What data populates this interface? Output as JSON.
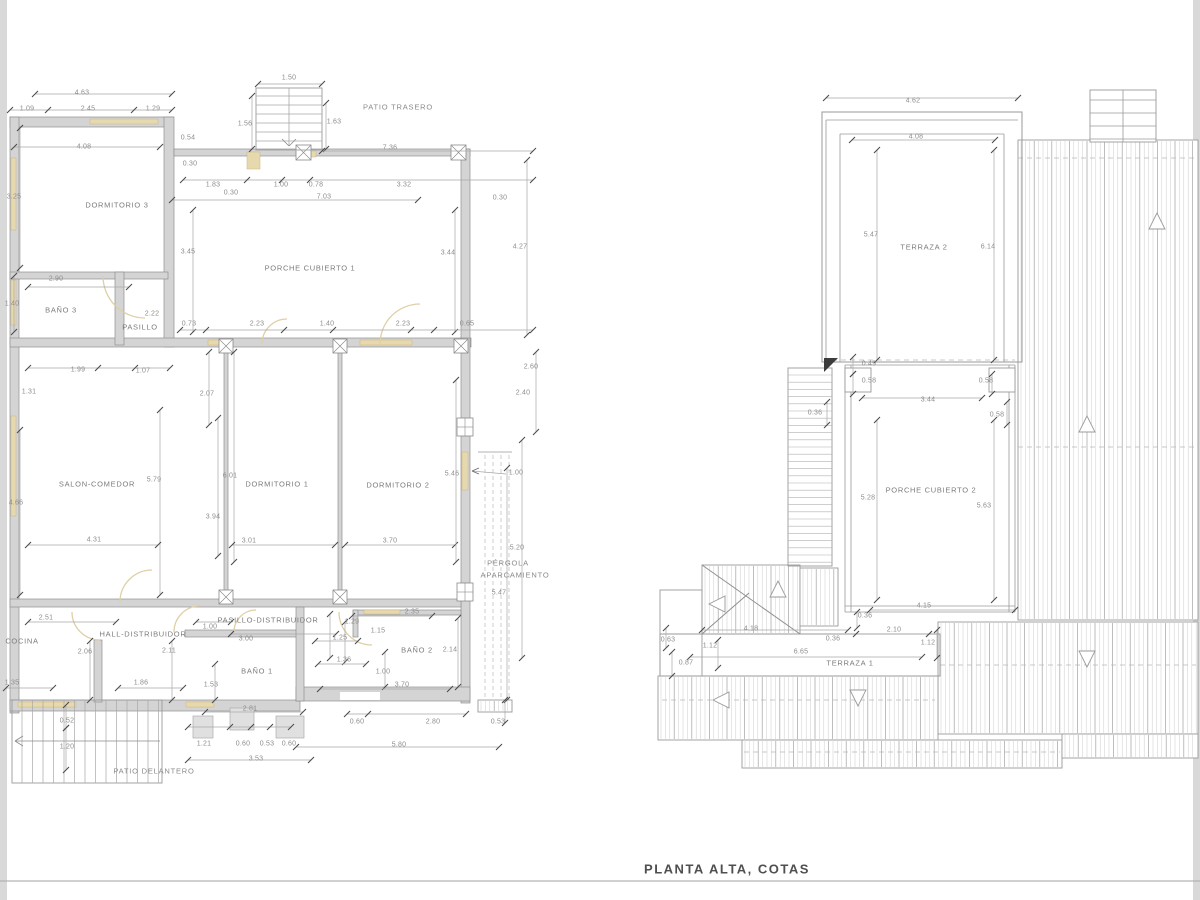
{
  "sheet_title": "PLANTA ALTA, COTAS",
  "colors": {
    "wall_fill": "#d4d4d4",
    "window_tan": "#e7d9ae",
    "door_arc": "#dfcfa5",
    "line_gray": "#9a9a9a",
    "text_gray": "#8a8a8a",
    "edge_strip": "#d9d9d9"
  },
  "left_plan": {
    "rooms_summary": [
      "DORMITORIO 3",
      "BAÑO 3",
      "PASILLO",
      "PORCHE CUBIERTO 1",
      "SALON-COMEDOR",
      "DORMITORIO 1",
      "DORMITORIO 2",
      "COCINA",
      "HALL-DISTRIBUIDOR",
      "PASILLO-DISTRIBUIDOR",
      "BAÑO 1",
      "BAÑO 2"
    ],
    "outdoor_areas": [
      "PATIO TRASERO",
      "PATIO DELANTERO",
      "PÉRGOLA APARCAMIENTO"
    ],
    "labels": [
      {
        "text": "4.63",
        "x": 82,
        "y": 93,
        "type": "dim"
      },
      {
        "text": "1.09",
        "x": 27,
        "y": 109,
        "type": "dim"
      },
      {
        "text": "2.45",
        "x": 88,
        "y": 109,
        "type": "dim"
      },
      {
        "text": "1.29",
        "x": 153,
        "y": 109,
        "type": "dim"
      },
      {
        "text": "4.08",
        "x": 84,
        "y": 147,
        "type": "dim"
      },
      {
        "text": "3.25",
        "x": 14,
        "y": 197,
        "type": "dim"
      },
      {
        "text": "1.50",
        "x": 289,
        "y": 78,
        "type": "dim"
      },
      {
        "text": "1.56",
        "x": 245,
        "y": 124,
        "type": "dim"
      },
      {
        "text": "1.63",
        "x": 334,
        "y": 122,
        "type": "dim"
      },
      {
        "text": "PATIO TRASERO",
        "x": 398,
        "y": 107,
        "type": "area"
      },
      {
        "text": "7.36",
        "x": 390,
        "y": 148,
        "type": "dim"
      },
      {
        "text": "0.54",
        "x": 188,
        "y": 138,
        "type": "dim"
      },
      {
        "text": "0.30",
        "x": 190,
        "y": 164,
        "type": "dim"
      },
      {
        "text": "1.83",
        "x": 213,
        "y": 185,
        "type": "dim"
      },
      {
        "text": "0.30",
        "x": 231,
        "y": 193,
        "type": "dim"
      },
      {
        "text": "1.00",
        "x": 281,
        "y": 185,
        "type": "dim"
      },
      {
        "text": "0.78",
        "x": 316,
        "y": 185,
        "type": "dim"
      },
      {
        "text": "3.32",
        "x": 404,
        "y": 185,
        "type": "dim"
      },
      {
        "text": "7.03",
        "x": 324,
        "y": 197,
        "type": "dim"
      },
      {
        "text": "0.30",
        "x": 500,
        "y": 198,
        "type": "dim"
      },
      {
        "text": "4.27",
        "x": 520,
        "y": 247,
        "type": "dim"
      },
      {
        "text": "3.45",
        "x": 188,
        "y": 252,
        "type": "dim"
      },
      {
        "text": "3.44",
        "x": 448,
        "y": 253,
        "type": "dim"
      },
      {
        "text": "DORMITORIO 3",
        "x": 117,
        "y": 205,
        "type": "room"
      },
      {
        "text": "PORCHE CUBIERTO 1",
        "x": 310,
        "y": 268,
        "type": "room"
      },
      {
        "text": "2.90",
        "x": 56,
        "y": 279,
        "type": "dim"
      },
      {
        "text": "1.40",
        "x": 12,
        "y": 304,
        "type": "dim"
      },
      {
        "text": "BAÑO 3",
        "x": 61,
        "y": 310,
        "type": "room"
      },
      {
        "text": "2.22",
        "x": 152,
        "y": 314,
        "type": "dim"
      },
      {
        "text": "PASILLO",
        "x": 140,
        "y": 327,
        "type": "room"
      },
      {
        "text": "0.73",
        "x": 189,
        "y": 324,
        "type": "dim"
      },
      {
        "text": "2.23",
        "x": 257,
        "y": 324,
        "type": "dim"
      },
      {
        "text": "1.40",
        "x": 327,
        "y": 324,
        "type": "dim"
      },
      {
        "text": "2.23",
        "x": 403,
        "y": 324,
        "type": "dim"
      },
      {
        "text": "0.65",
        "x": 467,
        "y": 324,
        "type": "dim"
      },
      {
        "text": "1.99",
        "x": 78,
        "y": 370,
        "type": "dim"
      },
      {
        "text": "1.07",
        "x": 143,
        "y": 371,
        "type": "dim"
      },
      {
        "text": "1.31",
        "x": 29,
        "y": 392,
        "type": "dim"
      },
      {
        "text": "2.07",
        "x": 207,
        "y": 394,
        "type": "dim"
      },
      {
        "text": "2.60",
        "x": 531,
        "y": 367,
        "type": "dim"
      },
      {
        "text": "2.40",
        "x": 523,
        "y": 393,
        "type": "dim"
      },
      {
        "text": "4.66",
        "x": 16,
        "y": 503,
        "type": "dim"
      },
      {
        "text": "SALON-COMEDOR",
        "x": 97,
        "y": 484,
        "type": "room"
      },
      {
        "text": "5.79",
        "x": 154,
        "y": 480,
        "type": "dim"
      },
      {
        "text": "6.01",
        "x": 230,
        "y": 476,
        "type": "dim"
      },
      {
        "text": "3.94",
        "x": 213,
        "y": 517,
        "type": "dim"
      },
      {
        "text": "DORMITORIO 1",
        "x": 277,
        "y": 484,
        "type": "room"
      },
      {
        "text": "DORMITORIO 2",
        "x": 398,
        "y": 485,
        "type": "room"
      },
      {
        "text": "4.31",
        "x": 94,
        "y": 540,
        "type": "dim"
      },
      {
        "text": "3.01",
        "x": 249,
        "y": 541,
        "type": "dim"
      },
      {
        "text": "3.70",
        "x": 390,
        "y": 541,
        "type": "dim"
      },
      {
        "text": "5.46",
        "x": 452,
        "y": 474,
        "type": "dim"
      },
      {
        "text": "1.00",
        "x": 516,
        "y": 473,
        "type": "dim"
      },
      {
        "text": "5.20",
        "x": 517,
        "y": 548,
        "type": "dim"
      },
      {
        "text": "PÉRGOLA",
        "x": 508,
        "y": 563,
        "type": "area"
      },
      {
        "text": "APARCAMIENTO",
        "x": 515,
        "y": 575,
        "type": "area"
      },
      {
        "text": "5.47",
        "x": 499,
        "y": 593,
        "type": "dim"
      },
      {
        "text": "2.35",
        "x": 412,
        "y": 612,
        "type": "dim"
      },
      {
        "text": "1.29",
        "x": 352,
        "y": 622,
        "type": "dim"
      },
      {
        "text": "1.15",
        "x": 378,
        "y": 631,
        "type": "dim"
      },
      {
        "text": "1.25",
        "x": 340,
        "y": 638,
        "type": "dim"
      },
      {
        "text": "BAÑO 2",
        "x": 417,
        "y": 650,
        "type": "room"
      },
      {
        "text": "2.14",
        "x": 450,
        "y": 650,
        "type": "dim"
      },
      {
        "text": "1.36",
        "x": 344,
        "y": 660,
        "type": "dim"
      },
      {
        "text": "1.00",
        "x": 383,
        "y": 672,
        "type": "dim"
      },
      {
        "text": "3.70",
        "x": 402,
        "y": 685,
        "type": "dim"
      },
      {
        "text": "2.51",
        "x": 46,
        "y": 618,
        "type": "dim"
      },
      {
        "text": "COCINA",
        "x": 22,
        "y": 641,
        "type": "room"
      },
      {
        "text": "HALL-DISTRIBUIDOR",
        "x": 143,
        "y": 634,
        "type": "room"
      },
      {
        "text": "PASILLO-DISTRIBUIDOR",
        "x": 268,
        "y": 620,
        "type": "room"
      },
      {
        "text": "1.00",
        "x": 210,
        "y": 627,
        "type": "dim"
      },
      {
        "text": "3.00",
        "x": 246,
        "y": 639,
        "type": "dim"
      },
      {
        "text": "2.06",
        "x": 85,
        "y": 652,
        "type": "dim"
      },
      {
        "text": "2.11",
        "x": 169,
        "y": 651,
        "type": "dim"
      },
      {
        "text": "1.35",
        "x": 12,
        "y": 683,
        "type": "dim"
      },
      {
        "text": "1.86",
        "x": 141,
        "y": 683,
        "type": "dim"
      },
      {
        "text": "1.53",
        "x": 211,
        "y": 685,
        "type": "dim"
      },
      {
        "text": "BAÑO 1",
        "x": 257,
        "y": 671,
        "type": "room"
      },
      {
        "text": "2.81",
        "x": 250,
        "y": 709,
        "type": "dim"
      },
      {
        "text": "0.52",
        "x": 67,
        "y": 721,
        "type": "dim"
      },
      {
        "text": "1.20",
        "x": 67,
        "y": 747,
        "type": "dim"
      },
      {
        "text": "1.21",
        "x": 204,
        "y": 744,
        "type": "dim"
      },
      {
        "text": "0.60",
        "x": 243,
        "y": 744,
        "type": "dim"
      },
      {
        "text": "0.53",
        "x": 267,
        "y": 744,
        "type": "dim"
      },
      {
        "text": "0.60",
        "x": 289,
        "y": 744,
        "type": "dim"
      },
      {
        "text": "3.53",
        "x": 256,
        "y": 759,
        "type": "dim"
      },
      {
        "text": "0.60",
        "x": 357,
        "y": 722,
        "type": "dim"
      },
      {
        "text": "2.80",
        "x": 433,
        "y": 722,
        "type": "dim"
      },
      {
        "text": "0.53",
        "x": 498,
        "y": 722,
        "type": "dim"
      },
      {
        "text": "5.80",
        "x": 399,
        "y": 745,
        "type": "dim"
      },
      {
        "text": "PATIO DELANTERO",
        "x": 154,
        "y": 771,
        "type": "area"
      }
    ]
  },
  "right_plan": {
    "rooms_summary": [
      "TERRAZA 2",
      "PORCHE CUBIERTO 2",
      "TERRAZA 1"
    ],
    "labels": [
      {
        "text": "4.62",
        "x": 913,
        "y": 101,
        "type": "dim"
      },
      {
        "text": "4.08",
        "x": 916,
        "y": 137,
        "type": "dim"
      },
      {
        "text": "5.47",
        "x": 871,
        "y": 235,
        "type": "dim"
      },
      {
        "text": "TERRAZA 2",
        "x": 924,
        "y": 247,
        "type": "room"
      },
      {
        "text": "6.14",
        "x": 988,
        "y": 247,
        "type": "dim"
      },
      {
        "text": "0.49",
        "x": 869,
        "y": 364,
        "type": "dim"
      },
      {
        "text": "0.58",
        "x": 869,
        "y": 381,
        "type": "dim"
      },
      {
        "text": "0.58",
        "x": 986,
        "y": 381,
        "type": "dim"
      },
      {
        "text": "3.44",
        "x": 928,
        "y": 400,
        "type": "dim"
      },
      {
        "text": "0.36",
        "x": 815,
        "y": 413,
        "type": "dim"
      },
      {
        "text": "0.58",
        "x": 997,
        "y": 415,
        "type": "dim"
      },
      {
        "text": "5.28",
        "x": 868,
        "y": 498,
        "type": "dim"
      },
      {
        "text": "PORCHE CUBIERTO 2",
        "x": 931,
        "y": 490,
        "type": "room"
      },
      {
        "text": "5.63",
        "x": 984,
        "y": 506,
        "type": "dim"
      },
      {
        "text": "4.15",
        "x": 924,
        "y": 606,
        "type": "dim"
      },
      {
        "text": "0.36",
        "x": 865,
        "y": 616,
        "type": "dim"
      },
      {
        "text": "4.18",
        "x": 751,
        "y": 629,
        "type": "dim"
      },
      {
        "text": "2.10",
        "x": 894,
        "y": 630,
        "type": "dim"
      },
      {
        "text": "0.36",
        "x": 833,
        "y": 639,
        "type": "dim"
      },
      {
        "text": "1.12",
        "x": 928,
        "y": 643,
        "type": "dim"
      },
      {
        "text": "1.12",
        "x": 710,
        "y": 646,
        "type": "dim"
      },
      {
        "text": "0.63",
        "x": 668,
        "y": 640,
        "type": "dim"
      },
      {
        "text": "6.65",
        "x": 801,
        "y": 652,
        "type": "dim"
      },
      {
        "text": "0.87",
        "x": 686,
        "y": 663,
        "type": "dim"
      },
      {
        "text": "TERRAZA 1",
        "x": 850,
        "y": 663,
        "type": "room"
      }
    ]
  }
}
